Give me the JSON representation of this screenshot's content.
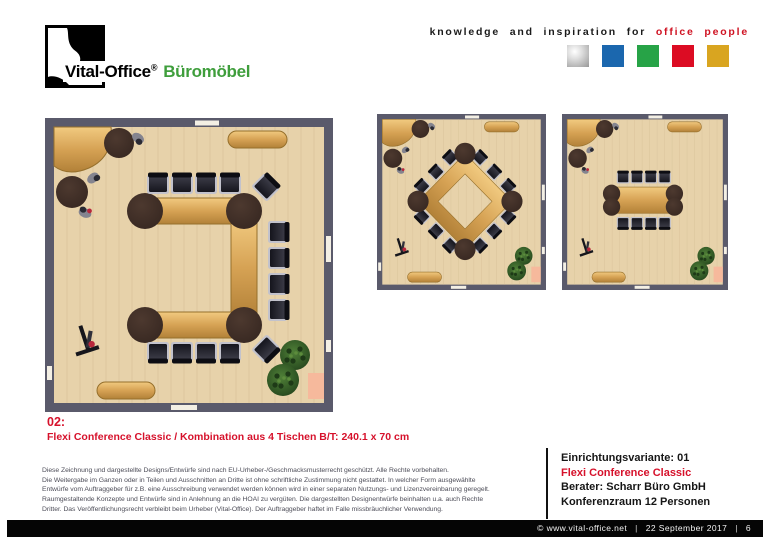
{
  "header": {
    "logo": {
      "brand": "Vital-Office",
      "registered": "®",
      "product_line": "Büromöbel",
      "product_color": "#3f9e3c"
    },
    "tagline": {
      "black_part": "knowledge and inspiration for",
      "red_part": "office people",
      "red_color": "#cf1222"
    },
    "color_squares": [
      "silver",
      "#1b67ae",
      "#27a347",
      "#dc0c23",
      "#d9a520"
    ]
  },
  "caption": {
    "number": "02:",
    "text": "Flexi Conference Classic / Kombination aus 4 Tischen B/T: 240.1 x 70 cm",
    "color": "#d6112b"
  },
  "disclaimer": {
    "lines": [
      "Diese Zeichnung und dargestellte Designs/Entwürfe sind nach EU-Urheber-/Geschmacksmusterrecht geschützt. Alle Rechte vorbehalten.",
      "Die Weitergabe im Ganzen oder in Teilen und Ausschnitten an Dritte ist ohne schriftliche Zustimmung nicht gestattet. In welcher Form ausgewählte",
      "Entwürfe vom Auftraggeber für z.B. eine Ausschreibung verwendet werden können wird in einer separaten Nutzungs- und Lizenzvereinbarung geregelt.",
      "Raumgestaltende Konzepte und Entwürfe sind in Anlehnung an die HOAI zu vergüten. Die dargestellten Designentwürfe beinhalten u.a. auch Rechte",
      "Dritter. Das Veröffentlichungsrecht verbleibt beim Urheber (Vital-Office). Der Auftraggeber haftet im Falle missbräuchlicher Verwendung."
    ]
  },
  "info_box": {
    "variant": "Einrichtungsvariante: 01",
    "product": "Flexi Conference Classic",
    "consultant": "Berater: Scharr Büro GmbH",
    "room": "Konferenzraum 12 Personen"
  },
  "footer": {
    "copyright": "© www.vital-office.net",
    "date": "22 September 2017",
    "page_number": "6",
    "separator": "|"
  },
  "floorplans": {
    "colors": {
      "wall": "#5a5a6b",
      "floor": "#e7d2aa",
      "stripe": "#dcc69e",
      "wood_hi": "#f1ca80",
      "wood_mid": "#d6a254",
      "wood_lo": "#b28138",
      "wood_stroke": "#96702c",
      "dark_round": "#352620",
      "chair_frame": "#c2c2cc",
      "chair_back": "#0d0d13",
      "plant_dot": "#1e3a17",
      "plant_dot2": "#5c8c3c",
      "pink": "#f6b99c",
      "mark": "#f3efe4",
      "person": "#84848f",
      "person_head": "#2a2a33",
      "person_red": "#b8273c"
    },
    "items": [
      {
        "name": "floorplan-u-shape-12-seats",
        "layout": "u"
      },
      {
        "name": "floorplan-diamond-12-seats",
        "layout": "diamond"
      },
      {
        "name": "floorplan-straight-table-8-seats",
        "layout": "rect"
      }
    ]
  }
}
